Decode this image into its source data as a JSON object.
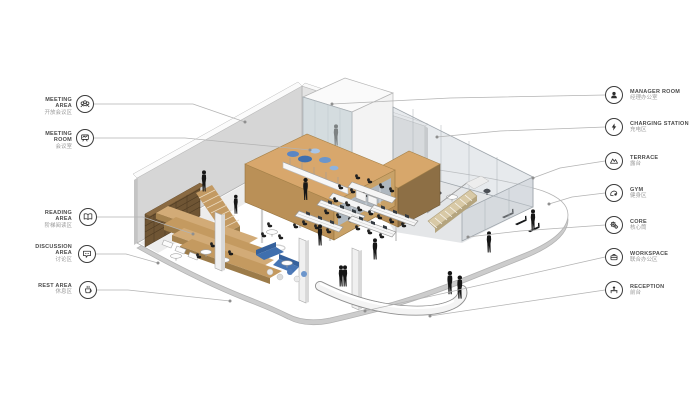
{
  "page": {
    "background": "#ffffff",
    "type": "axonometric office floor-plan diagram with legend callouts"
  },
  "palette": {
    "wall": "#d6d6d6",
    "back_wall": "#e3e3e3",
    "box_top": "#d8a76c",
    "box_side": "#ba9057",
    "box_dark_side": "#8d6f45",
    "wood": "#cfa873",
    "bookshelf": "#6f5534",
    "glass": "#c6cdd3",
    "sofa_blue": "#3f6fae",
    "lounger_blue": "#6c96cc",
    "figure_black": "#161616",
    "leader_line": "#b3b3b3",
    "icon_ink": "#2e2e2e"
  },
  "legend": {
    "left": [
      {
        "id": "meeting-area",
        "en": "MEETING AREA",
        "zh": "开放会议区",
        "icon": "people-group-icon"
      },
      {
        "id": "meeting-room",
        "en": "MEETING ROOM",
        "zh": "会议室",
        "icon": "presentation-screen-icon"
      },
      {
        "id": "reading-area",
        "en": "READING AREA",
        "zh": "阶梯阅读区",
        "icon": "open-book-icon"
      },
      {
        "id": "discussion-area",
        "en": "DISCUSSION AREA",
        "zh": "讨论区",
        "icon": "speech-bubble-icon"
      },
      {
        "id": "rest-area",
        "en": "REST AREA",
        "zh": "休息区",
        "icon": "coffee-cup-icon"
      }
    ],
    "right": [
      {
        "id": "manager-room",
        "en": "MANAGER ROOM",
        "zh": "经理办公室",
        "icon": "person-bust-icon"
      },
      {
        "id": "charging-station",
        "en": "CHARGING STATION",
        "zh": "充电区",
        "icon": "lightning-bolt-icon"
      },
      {
        "id": "terrace",
        "en": "TERRACE",
        "zh": "露台",
        "icon": "mountains-icon"
      },
      {
        "id": "gym",
        "en": "GYM",
        "zh": "健身区",
        "icon": "flex-arm-icon"
      },
      {
        "id": "core",
        "en": "CORE",
        "zh": "核心筒",
        "icon": "gears-icon"
      },
      {
        "id": "workspace",
        "en": "WORKSPACE",
        "zh": "联合办公区",
        "icon": "briefcase-icon"
      },
      {
        "id": "reception",
        "en": "RECEPTION",
        "zh": "前台",
        "icon": "reception-desk-icon"
      }
    ]
  }
}
